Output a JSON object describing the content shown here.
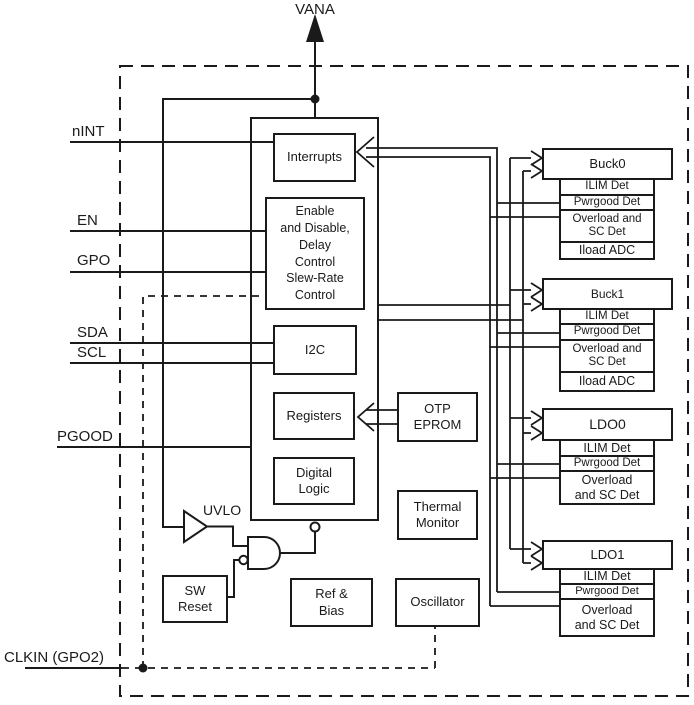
{
  "diagram": {
    "power_pin": "VANA",
    "pins": {
      "nint": "nINT",
      "en": "EN",
      "gpo": "GPO",
      "sda": "SDA",
      "scl": "SCL",
      "pgood": "PGOOD",
      "clkin": "CLKIN (GPO2)"
    },
    "core": {
      "interrupts": "Interrupts",
      "enable_block": "Enable\nand Disable,\nDelay\nControl\nSlew-Rate\nControl",
      "i2c": "I2C",
      "registers": "Registers",
      "digital_logic": "Digital\nLogic",
      "otp": "OTP\nEPROM",
      "thermal": "Thermal\nMonitor",
      "uvlo": "UVLO",
      "sw_reset": "SW\nReset",
      "ref_bias": "Ref &\nBias",
      "oscillator": "Oscillator"
    },
    "regulators": [
      {
        "name": "Buck0",
        "rows": [
          "ILIM Det",
          "Pwrgood Det",
          "Overload and\nSC Det",
          "Iload ADC"
        ]
      },
      {
        "name": "Buck1",
        "rows": [
          "ILIM Det",
          "Pwrgood Det",
          "Overload and\nSC Det",
          "Iload ADC"
        ]
      },
      {
        "name": "LDO0",
        "rows": [
          "ILIM Det",
          "Pwrgood Det",
          "Overload\nand SC Det"
        ]
      },
      {
        "name": "LDO1",
        "rows": [
          "ILIM Det",
          "Pwrgood Det",
          "Overload\nand SC Det"
        ]
      }
    ],
    "colors": {
      "line": "#1a1a1a",
      "background": "#ffffff"
    }
  }
}
